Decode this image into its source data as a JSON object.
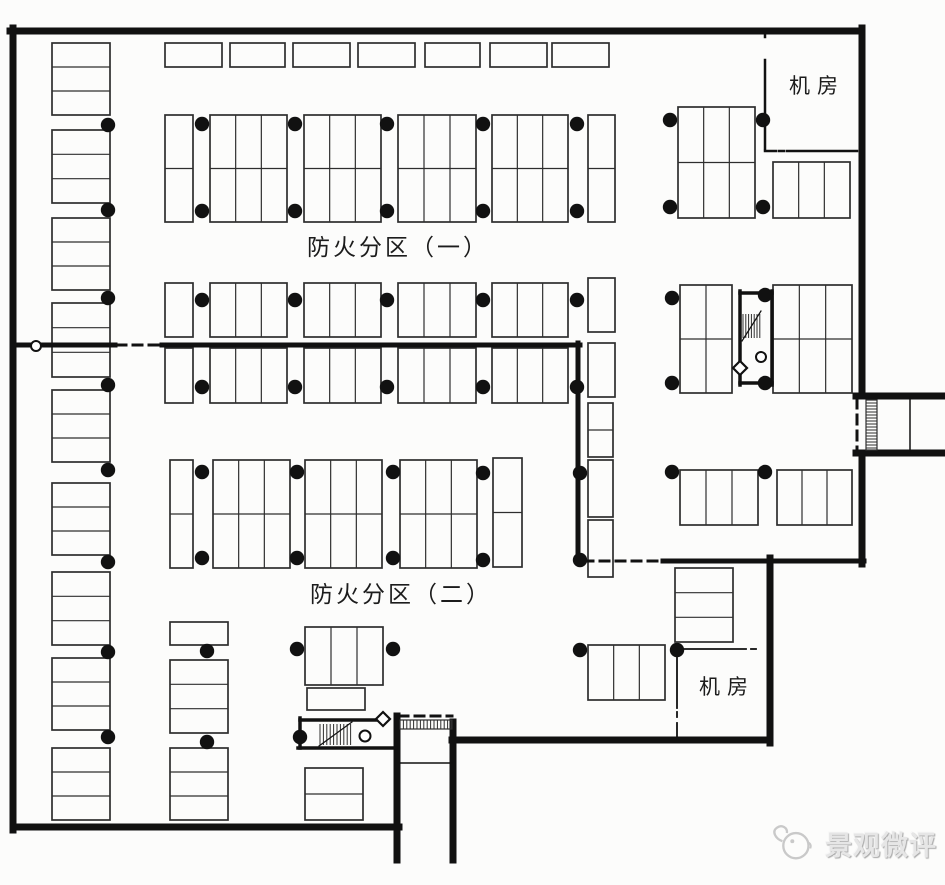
{
  "labels": {
    "fire_zone_1": "防火分区（一）",
    "fire_zone_2": "防火分区（二）",
    "machine_room_top": "机房",
    "machine_room_bottom": "机房",
    "watermark": "景观微评"
  },
  "colors": {
    "paper": "#fcfcfb",
    "ink": "#111111",
    "line": "#2e2e2e",
    "watermark": "#c9c9c9"
  },
  "plan": {
    "width": 945,
    "height": 885,
    "walls_exterior": [
      [
        10,
        31,
        862,
        31
      ],
      [
        13,
        28,
        13,
        830
      ],
      [
        13,
        827,
        399,
        827
      ],
      [
        862,
        28,
        862,
        396
      ],
      [
        856,
        396,
        945,
        396
      ],
      [
        856,
        453,
        945,
        453
      ],
      [
        862,
        453,
        862,
        564
      ],
      [
        770,
        558,
        770,
        743
      ],
      [
        770,
        740,
        452,
        740
      ],
      [
        453,
        722,
        453,
        860
      ],
      [
        397,
        716,
        397,
        860
      ]
    ],
    "walls_fire": [
      [
        14,
        345,
        115,
        345
      ],
      [
        162,
        345,
        580,
        345
      ],
      [
        578,
        343,
        578,
        562
      ],
      [
        663,
        561,
        864,
        561
      ]
    ],
    "walls_stair": [
      [
        740,
        293,
        772,
        293
      ],
      [
        772,
        291,
        772,
        385
      ],
      [
        740,
        291,
        740,
        385
      ],
      [
        740,
        383,
        772,
        383
      ],
      [
        300,
        720,
        378,
        720
      ],
      [
        300,
        718,
        300,
        748
      ],
      [
        298,
        748,
        396,
        748
      ]
    ],
    "walls_medium": [
      [
        765,
        31,
        765,
        37
      ],
      [
        765,
        60,
        765,
        149
      ],
      [
        765,
        151,
        776,
        151
      ],
      [
        787,
        151,
        857,
        151
      ]
    ],
    "walls_medium_dashed": [
      [
        779,
        151,
        784,
        151
      ]
    ],
    "walls_thin": [
      [
        677,
        649,
        746,
        649
      ],
      [
        677,
        649,
        677,
        708
      ],
      [
        677,
        723,
        677,
        739
      ]
    ],
    "walls_thin_dashed": [
      [
        751,
        649,
        758,
        649
      ],
      [
        677,
        712,
        677,
        719
      ]
    ],
    "walls_dashed": [
      [
        117,
        345,
        161,
        345
      ],
      [
        584,
        561,
        660,
        561
      ],
      [
        857,
        399,
        857,
        451
      ],
      [
        399,
        716,
        452,
        716
      ]
    ],
    "stall_groups": [
      [
        52,
        43,
        58,
        72,
        1,
        3
      ],
      [
        52,
        130,
        58,
        73,
        1,
        3
      ],
      [
        52,
        218,
        58,
        72,
        1,
        3
      ],
      [
        52,
        303,
        58,
        74,
        1,
        3
      ],
      [
        52,
        390,
        58,
        72,
        1,
        3
      ],
      [
        52,
        483,
        58,
        72,
        1,
        3
      ],
      [
        52,
        572,
        58,
        73,
        1,
        3
      ],
      [
        52,
        658,
        58,
        72,
        1,
        3
      ],
      [
        52,
        748,
        58,
        72,
        1,
        3
      ],
      [
        170,
        622,
        58,
        23,
        1,
        1
      ],
      [
        170,
        660,
        58,
        73,
        1,
        3
      ],
      [
        170,
        748,
        58,
        72,
        1,
        3
      ],
      [
        165,
        43,
        57,
        24,
        1,
        1
      ],
      [
        230,
        43,
        55,
        24,
        1,
        1
      ],
      [
        293,
        43,
        57,
        24,
        1,
        1
      ],
      [
        358,
        43,
        57,
        24,
        1,
        1
      ],
      [
        425,
        43,
        55,
        24,
        1,
        1
      ],
      [
        490,
        43,
        57,
        24,
        1,
        1
      ],
      [
        552,
        43,
        57,
        24,
        1,
        1
      ],
      [
        165,
        115,
        28,
        107,
        1,
        2
      ],
      [
        210,
        115,
        77,
        107,
        3,
        2
      ],
      [
        304,
        115,
        77,
        107,
        3,
        2
      ],
      [
        398,
        115,
        78,
        107,
        3,
        2
      ],
      [
        492,
        115,
        76,
        107,
        3,
        2
      ],
      [
        588,
        115,
        27,
        107,
        1,
        2
      ],
      [
        678,
        107,
        77,
        111,
        3,
        2
      ],
      [
        773,
        162,
        77,
        56,
        3,
        1
      ],
      [
        165,
        283,
        28,
        54,
        1,
        1
      ],
      [
        210,
        283,
        77,
        54,
        3,
        1
      ],
      [
        304,
        283,
        77,
        54,
        3,
        1
      ],
      [
        398,
        283,
        78,
        54,
        3,
        1
      ],
      [
        492,
        283,
        76,
        54,
        3,
        1
      ],
      [
        588,
        278,
        27,
        54,
        1,
        1
      ],
      [
        165,
        348,
        28,
        55,
        1,
        1
      ],
      [
        210,
        348,
        77,
        55,
        3,
        1
      ],
      [
        304,
        348,
        77,
        55,
        3,
        1
      ],
      [
        398,
        348,
        78,
        55,
        3,
        1
      ],
      [
        492,
        348,
        76,
        55,
        3,
        1
      ],
      [
        588,
        343,
        27,
        54,
        1,
        1
      ],
      [
        680,
        285,
        52,
        108,
        2,
        2
      ],
      [
        773,
        285,
        79,
        108,
        3,
        2
      ],
      [
        588,
        403,
        25,
        54,
        1,
        2
      ],
      [
        588,
        460,
        25,
        57,
        1,
        1
      ],
      [
        588,
        520,
        25,
        57,
        1,
        1
      ],
      [
        170,
        460,
        23,
        108,
        1,
        2
      ],
      [
        213,
        460,
        77,
        108,
        3,
        2
      ],
      [
        305,
        460,
        77,
        108,
        3,
        2
      ],
      [
        400,
        460,
        77,
        108,
        3,
        2
      ],
      [
        493,
        458,
        29,
        109,
        1,
        2
      ],
      [
        680,
        470,
        78,
        55,
        3,
        1
      ],
      [
        777,
        470,
        75,
        55,
        3,
        1
      ],
      [
        305,
        627,
        78,
        58,
        3,
        1
      ],
      [
        307,
        688,
        58,
        22,
        1,
        1
      ],
      [
        305,
        768,
        58,
        52,
        1,
        2
      ],
      [
        588,
        645,
        77,
        55,
        3,
        1
      ],
      [
        675,
        568,
        58,
        74,
        1,
        3
      ]
    ],
    "dots": [
      [
        108,
        125
      ],
      [
        108,
        210
      ],
      [
        108,
        298
      ],
      [
        108,
        385
      ],
      [
        108,
        470
      ],
      [
        108,
        562
      ],
      [
        108,
        652
      ],
      [
        108,
        737
      ],
      [
        207,
        651
      ],
      [
        207,
        742
      ],
      [
        202,
        124
      ],
      [
        295,
        124
      ],
      [
        387,
        124
      ],
      [
        483,
        124
      ],
      [
        577,
        124
      ],
      [
        202,
        211
      ],
      [
        295,
        211
      ],
      [
        387,
        211
      ],
      [
        483,
        211
      ],
      [
        577,
        211
      ],
      [
        670,
        120
      ],
      [
        763,
        120
      ],
      [
        670,
        207
      ],
      [
        763,
        207
      ],
      [
        202,
        300
      ],
      [
        295,
        300
      ],
      [
        387,
        300
      ],
      [
        483,
        300
      ],
      [
        577,
        300
      ],
      [
        202,
        387
      ],
      [
        295,
        387
      ],
      [
        387,
        387
      ],
      [
        483,
        387
      ],
      [
        577,
        387
      ],
      [
        672,
        298
      ],
      [
        672,
        383
      ],
      [
        765,
        295
      ],
      [
        765,
        383
      ],
      [
        202,
        472
      ],
      [
        297,
        472
      ],
      [
        393,
        472
      ],
      [
        483,
        473
      ],
      [
        580,
        473
      ],
      [
        202,
        558
      ],
      [
        297,
        558
      ],
      [
        393,
        558
      ],
      [
        483,
        560
      ],
      [
        580,
        560
      ],
      [
        672,
        472
      ],
      [
        765,
        472
      ],
      [
        297,
        649
      ],
      [
        393,
        649
      ],
      [
        580,
        650
      ],
      [
        677,
        650
      ],
      [
        300,
        737
      ]
    ],
    "hatches": [
      {
        "x": 866,
        "y": 400,
        "w": 11,
        "h": 50,
        "dir": "h",
        "step": 3,
        "box": true
      },
      {
        "x": 400,
        "y": 720,
        "w": 52,
        "h": 9,
        "dir": "v",
        "step": 3.4,
        "box": true
      },
      {
        "x": 743,
        "y": 314,
        "w": 17,
        "h": 24,
        "dir": "v",
        "step": 2.8,
        "box": false
      },
      {
        "x": 320,
        "y": 724,
        "w": 31,
        "h": 21,
        "dir": "v",
        "step": 3.4,
        "box": false
      }
    ],
    "diag_lines": [
      [
        742,
        341,
        761,
        311
      ],
      [
        319,
        746,
        352,
        722
      ]
    ],
    "extra_lines": [
      [
        910,
        398,
        910,
        451
      ],
      [
        400,
        763,
        452,
        763
      ]
    ],
    "circles": [
      {
        "x": 36,
        "y": 346,
        "r": 5
      },
      {
        "x": 761,
        "y": 357,
        "r": 5
      },
      {
        "x": 365,
        "y": 736,
        "r": 5.5
      }
    ],
    "diamonds": [
      {
        "x": 740,
        "y": 368,
        "r": 7
      },
      {
        "x": 383,
        "y": 719,
        "r": 7
      }
    ]
  }
}
